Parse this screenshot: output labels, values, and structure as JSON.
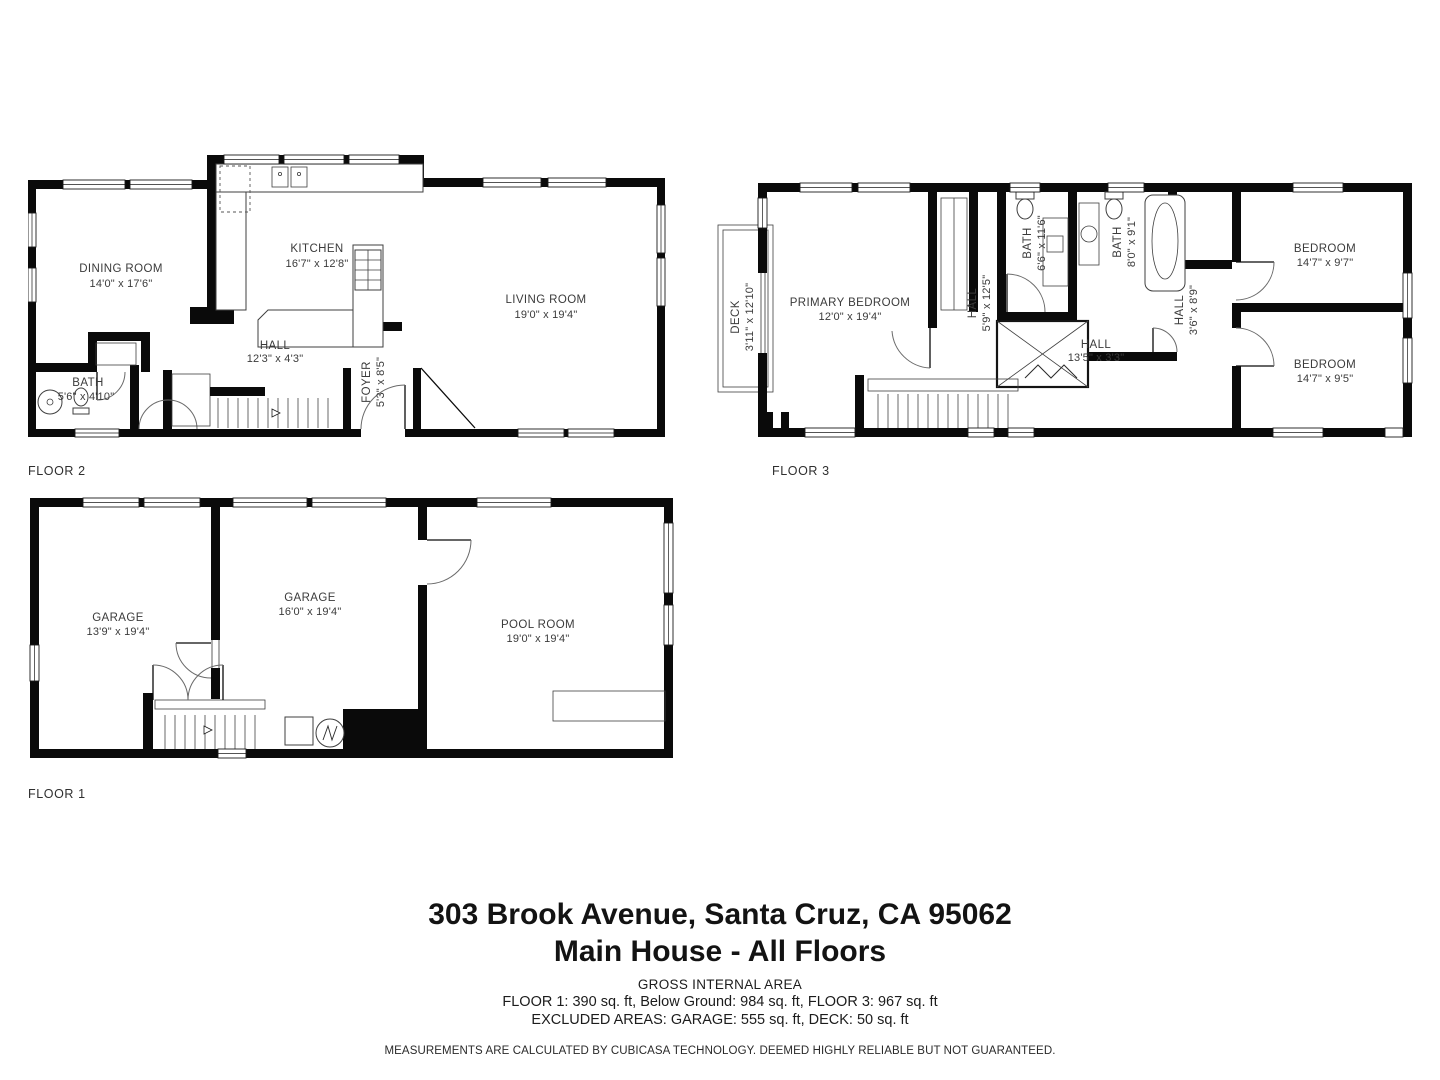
{
  "title_block": {
    "address": "303 Brook Avenue, Santa Cruz, CA 95062",
    "subtitle": "Main House - All Floors",
    "area_heading": "GROSS INTERNAL AREA",
    "area_line1": "FLOOR 1: 390 sq. ft, Below Ground: 984 sq. ft, FLOOR 3: 967 sq. ft",
    "area_line2": "EXCLUDED AREAS: GARAGE: 555 sq. ft, DECK: 50 sq. ft",
    "disclaimer": "MEASUREMENTS ARE CALCULATED BY CUBICASA TECHNOLOGY. DEEMED HIGHLY RELIABLE BUT NOT GUARANTEED."
  },
  "floors": {
    "floor2": {
      "label": "FLOOR 2",
      "rooms": {
        "dining": {
          "name": "DINING ROOM",
          "dims": "14'0\" x 17'6\""
        },
        "kitchen": {
          "name": "KITCHEN",
          "dims": "16'7\" x 12'8\""
        },
        "living": {
          "name": "LIVING ROOM",
          "dims": "19'0\" x 19'4\""
        },
        "hall": {
          "name": "HALL",
          "dims": "12'3\" x 4'3\""
        },
        "bath": {
          "name": "BATH",
          "dims": "5'6\" x 4'10\""
        },
        "foyer": {
          "name": "FOYER",
          "dims": "5'3\" x 8'5\""
        }
      }
    },
    "floor3": {
      "label": "FLOOR 3",
      "rooms": {
        "deck": {
          "name": "DECK",
          "dims": "3'11\" x 12'10\""
        },
        "primary": {
          "name": "PRIMARY BEDROOM",
          "dims": "12'0\" x 19'4\""
        },
        "hall1": {
          "name": "HALL",
          "dims": "5'9\" x 12'5\""
        },
        "bath1": {
          "name": "BATH",
          "dims": "6'6\" x 11'6\""
        },
        "bath2": {
          "name": "BATH",
          "dims": "8'0\" x 9'1\""
        },
        "hall2": {
          "name": "HALL",
          "dims": "3'6\" x 8'9\""
        },
        "hall3": {
          "name": "HALL",
          "dims": "13'5\" x 3'3\""
        },
        "bedroom1": {
          "name": "BEDROOM",
          "dims": "14'7\" x 9'7\""
        },
        "bedroom2": {
          "name": "BEDROOM",
          "dims": "14'7\" x 9'5\""
        }
      }
    },
    "floor1": {
      "label": "FLOOR 1",
      "rooms": {
        "garage1": {
          "name": "GARAGE",
          "dims": "13'9\" x 19'4\""
        },
        "garage2": {
          "name": "GARAGE",
          "dims": "16'0\" x 19'4\""
        },
        "pool": {
          "name": "POOL ROOM",
          "dims": "19'0\" x 19'4\""
        }
      }
    }
  }
}
